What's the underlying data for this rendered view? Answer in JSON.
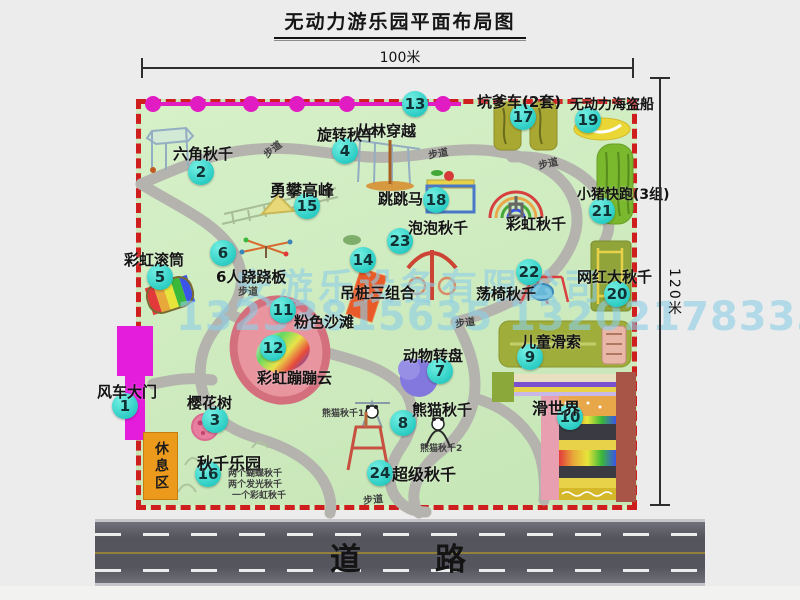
{
  "title": "无动力游乐园平面布局图",
  "dimensions": {
    "width_label": "100米",
    "height_label": "120米"
  },
  "road": {
    "label": "道　　路"
  },
  "watermark": {
    "line1": "安游乐设备有限公司",
    "line2": "13233815635 13202178333"
  },
  "rest_area": {
    "label": "休息区"
  },
  "colors": {
    "map_green": "#cdeabc",
    "border_red": "#ce1e1e",
    "badge_cyan": "#2bcdc4",
    "zipline_magenta": "#e01cc2",
    "gate_magenta": "#e41cdc",
    "road_gray": "#55555e",
    "rest_orange": "#ec9a1c",
    "watermark_blue": "#8ecfe6"
  },
  "attractions": [
    {
      "num": 1,
      "label": "风车大门",
      "bx": 125,
      "by": 406,
      "lx": 97,
      "ly": 381
    },
    {
      "num": 2,
      "label": "六角秋千",
      "bx": 201,
      "by": 172,
      "lx": 173,
      "ly": 143
    },
    {
      "num": 3,
      "label": "樱花树",
      "bx": 215,
      "by": 420,
      "lx": 187,
      "ly": 392
    },
    {
      "num": 4,
      "label": "旋转秋千",
      "bx": 345,
      "by": 151,
      "lx": 317,
      "ly": 124
    },
    {
      "num": 5,
      "label": "彩虹滚筒",
      "bx": 160,
      "by": 277,
      "lx": 124,
      "ly": 249
    },
    {
      "num": 6,
      "label": "6人跷跷板",
      "bx": 223,
      "by": 253,
      "lx": 216,
      "ly": 266
    },
    {
      "num": 7,
      "label": "动物转盘",
      "bx": 440,
      "by": 371,
      "lx": 403,
      "ly": 345
    },
    {
      "num": 8,
      "label": "熊猫秋千",
      "bx": 403,
      "by": 423,
      "lx": 412,
      "ly": 399
    },
    {
      "num": 9,
      "label": "儿童滑索",
      "bx": 530,
      "by": 357,
      "lx": 521,
      "ly": 331
    },
    {
      "num": 10,
      "label": "滑世界",
      "bx": 570,
      "by": 417,
      "lx": 532,
      "ly": 395,
      "fs": 16
    },
    {
      "num": 11,
      "label": "粉色沙滩",
      "bx": 283,
      "by": 310,
      "lx": 294,
      "ly": 311
    },
    {
      "num": 12,
      "label": "彩虹蹦蹦云",
      "bx": 273,
      "by": 348,
      "lx": 257,
      "ly": 367
    },
    {
      "num": 13,
      "label": "丛林穿越",
      "bx": 415,
      "by": 104,
      "lx": 356,
      "ly": 120
    },
    {
      "num": 14,
      "label": "吊桩三组合",
      "bx": 363,
      "by": 260,
      "lx": 340,
      "ly": 282
    },
    {
      "num": 15,
      "label": "勇攀高峰",
      "bx": 307,
      "by": 206,
      "lx": 270,
      "ly": 177,
      "fs": 16
    },
    {
      "num": 16,
      "label": "秋千乐园",
      "bx": 208,
      "by": 474,
      "lx": 197,
      "ly": 450,
      "fs": 16
    },
    {
      "num": 17,
      "label": "坑爹车(2套)",
      "bx": 523,
      "by": 117,
      "lx": 477,
      "ly": 91
    },
    {
      "num": 18,
      "label": "跳跳马",
      "bx": 436,
      "by": 200,
      "lx": 378,
      "ly": 188
    },
    {
      "num": 19,
      "label": "无动力海盗船",
      "bx": 588,
      "by": 120,
      "lx": 570,
      "ly": 94,
      "fs": 14
    },
    {
      "num": 20,
      "label": "网红大秋千",
      "bx": 617,
      "by": 294,
      "lx": 577,
      "ly": 266
    },
    {
      "num": 21,
      "label": "小猪快跑(3组)",
      "bx": 602,
      "by": 211,
      "lx": 577,
      "ly": 184,
      "fs": 14
    },
    {
      "num": 22,
      "label": "荡椅秋千",
      "bx": 529,
      "by": 272,
      "lx": 476,
      "ly": 283
    },
    {
      "num": 23,
      "label": "泡泡秋千",
      "bx": 400,
      "by": 241,
      "lx": 408,
      "ly": 217
    },
    {
      "num": 24,
      "label": "超级秋千",
      "bx": 380,
      "by": 473,
      "lx": 392,
      "ly": 461,
      "fs": 16
    },
    {
      "num": null,
      "label": "彩虹秋千",
      "lx": 506,
      "ly": 213
    }
  ],
  "small_labels": [
    {
      "text": "步道",
      "x": 262,
      "y": 141,
      "fs": 10,
      "rot": -38
    },
    {
      "text": "步道",
      "x": 428,
      "y": 145,
      "fs": 10,
      "rot": -10
    },
    {
      "text": "步道",
      "x": 538,
      "y": 155,
      "fs": 10,
      "rot": -12
    },
    {
      "text": "步道",
      "x": 238,
      "y": 283,
      "fs": 10,
      "rot": 0
    },
    {
      "text": "步道",
      "x": 455,
      "y": 314,
      "fs": 10,
      "rot": -8
    },
    {
      "text": "步道",
      "x": 363,
      "y": 491,
      "fs": 10,
      "rot": -6
    },
    {
      "text": "熊猫秋千1",
      "x": 322,
      "y": 406,
      "fs": 9,
      "rot": 0
    },
    {
      "text": "熊猫秋千2",
      "x": 420,
      "y": 441,
      "fs": 9,
      "rot": 0
    },
    {
      "text": "两个蝴蝶秋千",
      "x": 228,
      "y": 466,
      "fs": 9,
      "rot": 0
    },
    {
      "text": "两个发光秋千",
      "x": 228,
      "y": 477,
      "fs": 9,
      "rot": 0
    },
    {
      "text": "一个彩虹秋千",
      "x": 232,
      "y": 488,
      "fs": 9,
      "rot": 0
    }
  ]
}
